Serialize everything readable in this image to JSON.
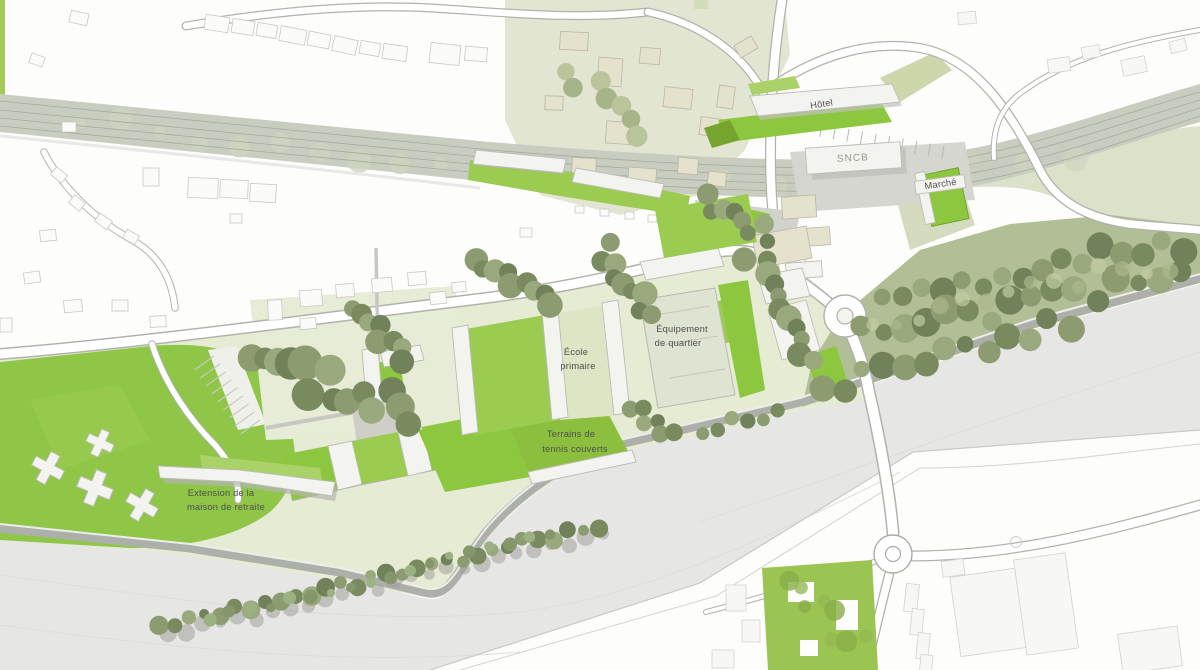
{
  "map": {
    "kind": "urban masterplan site plan (aerial rendering)",
    "labels": {
      "hotel": "Hôtel",
      "station": "SNCB",
      "market": "Marché",
      "equipment": [
        "Équipement",
        "de quartier"
      ],
      "school": [
        "École",
        "primaire"
      ],
      "tennis": [
        "Terrains de",
        "tennis couverts"
      ],
      "retirement": [
        "Extension de la",
        "maison de retraite"
      ]
    },
    "palette": {
      "lawn_bright": "#8dc63f",
      "lawn_medium": "#9bcb51",
      "parcel_pale_green": "#e7ecd6",
      "village_sage": "#dde1ca",
      "forest_base": "#b2be95",
      "tree_olive": "#7a8a5f",
      "railway_grey_green": "#c9cdc0",
      "river_grey": "#e6e7e5",
      "road_white": "#ffffff",
      "road_casing": "#b2b2ac",
      "building_white": "#f3f3f0",
      "building_cream": "#e4e1cd",
      "label_grey": "#4f4f4f"
    }
  }
}
